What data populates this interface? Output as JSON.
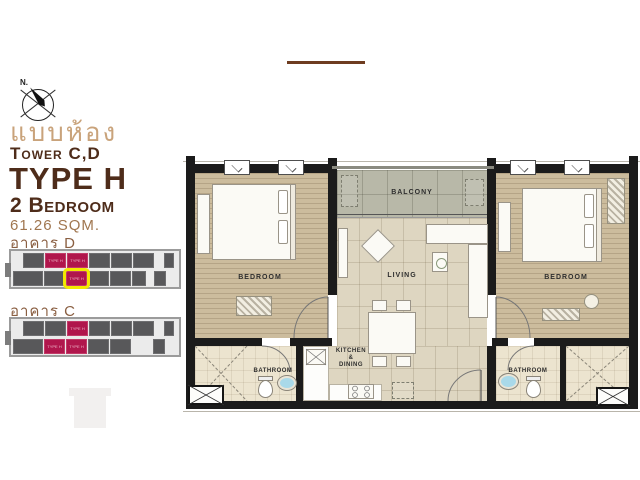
{
  "header": {
    "thai_title": "แบบห้อง",
    "tower": "Tower C,D",
    "unit_type": "TYPE H",
    "bedrooms": "2 Bedroom",
    "area": "61.26 SQM."
  },
  "compass": {
    "north_label": "N."
  },
  "keyplan": {
    "unit_label": "TYPE H",
    "building_d": {
      "label": "อาคาร D",
      "rows": [
        [
          {
            "t": "gray"
          },
          {
            "t": "red"
          },
          {
            "t": "red"
          },
          {
            "t": "gray"
          },
          {
            "t": "gray"
          },
          {
            "t": "gray"
          },
          {
            "t": "gap",
            "w": 8
          },
          {
            "t": "gray",
            "w": 10
          }
        ],
        [
          {
            "t": "gray",
            "w": 30
          },
          {
            "t": "gray"
          },
          {
            "t": "red",
            "hl": true
          },
          {
            "t": "gray"
          },
          {
            "t": "gray"
          },
          {
            "t": "gray",
            "w": 14
          },
          {
            "t": "gap",
            "w": 6
          },
          {
            "t": "gray",
            "w": 12
          }
        ]
      ]
    },
    "building_c": {
      "label": "อาคาร C",
      "rows": [
        [
          {
            "t": "gray"
          },
          {
            "t": "gray"
          },
          {
            "t": "red"
          },
          {
            "t": "gray"
          },
          {
            "t": "gray"
          },
          {
            "t": "gray"
          },
          {
            "t": "gap",
            "w": 8
          },
          {
            "t": "gray",
            "w": 10
          }
        ],
        [
          {
            "t": "gray",
            "w": 30
          },
          {
            "t": "red"
          },
          {
            "t": "red"
          },
          {
            "t": "gray"
          },
          {
            "t": "gray"
          },
          {
            "t": "gap",
            "w": 20
          },
          {
            "t": "gray",
            "w": 12
          }
        ]
      ]
    }
  },
  "plan": {
    "labels": {
      "balcony": "BALCONY",
      "living": "LIVING",
      "bedroom_left": "BEDROOM",
      "bedroom_right": "BEDROOM",
      "bathroom_left": "BATHROOM",
      "bathroom_right": "BATHROOM",
      "kitchen": [
        "KITCHEN",
        "&",
        "DINING"
      ]
    }
  },
  "colors": {
    "title_brown": "#4e2c1a",
    "title_tan": "#c9a37b",
    "accent_red_unit": "#b0164c",
    "highlight_yellow": "#f2ea00",
    "wall_black": "#1b1b1b"
  }
}
